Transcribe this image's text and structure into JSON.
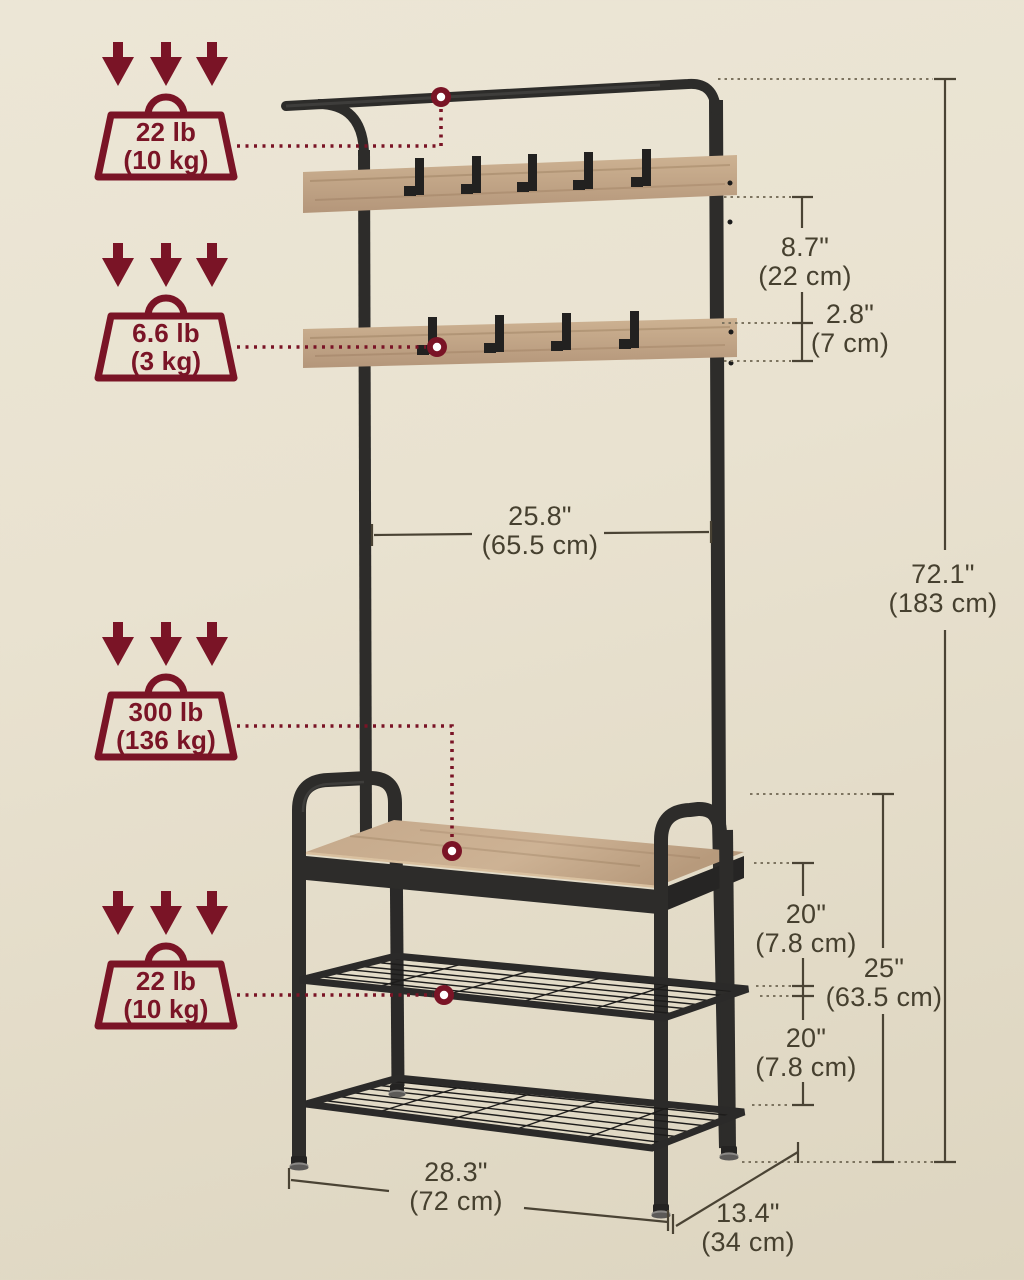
{
  "badges": {
    "top_rail_load": {
      "value": "22 lb",
      "metric": "(10 kg)"
    },
    "hook_row_load": {
      "value": "6.6 lb",
      "metric": "(3 kg)"
    },
    "bench_load": {
      "value": "300 lb",
      "metric": "(136 kg)"
    },
    "shelf_load": {
      "value": "22 lb",
      "metric": "(10 kg)"
    }
  },
  "dimensions": {
    "hook_row_spacing": {
      "inches": "8.7\"",
      "metric": "(22 cm)"
    },
    "slat_height": {
      "inches": "2.8\"",
      "metric": "(7 cm)"
    },
    "rod_width": {
      "inches": "25.8\"",
      "metric": "(65.5 cm)"
    },
    "total_height": {
      "inches": "72.1\"",
      "metric": "(183 cm)"
    },
    "upper_shelf_gap": {
      "inches": "20\"",
      "metric": "(7.8 cm)"
    },
    "bench_height": {
      "inches": "25\"",
      "metric": "(63.5 cm)"
    },
    "lower_shelf_gap": {
      "inches": "20\"",
      "metric": "(7.8 cm)"
    },
    "overall_width": {
      "inches": "28.3\"",
      "metric": "(72 cm)"
    },
    "overall_depth": {
      "inches": "13.4\"",
      "metric": "(34 cm)"
    }
  },
  "colors": {
    "accent": "#7a1426",
    "background": "#e9e2d0",
    "metal": "#2d2c2a",
    "wood": "#c3a484",
    "dimension_line": "#4a4334"
  }
}
